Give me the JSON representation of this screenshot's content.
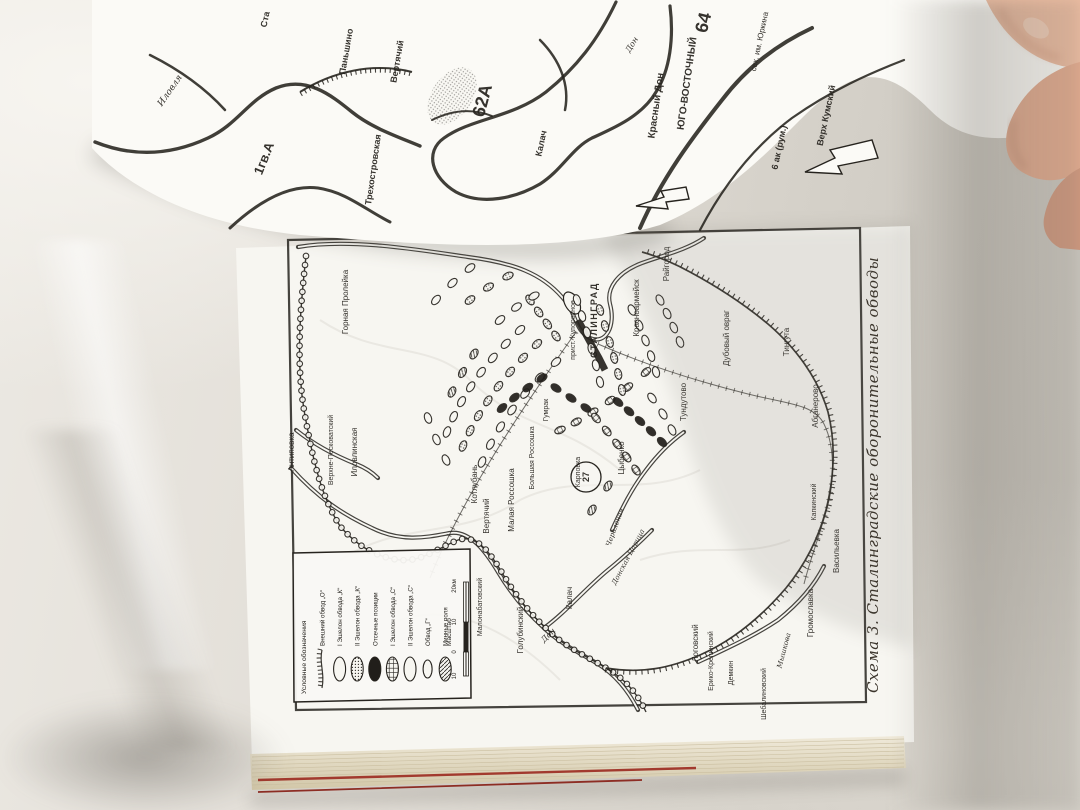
{
  "colors": {
    "page": "#f7f6f1",
    "page2": "#fbfaf6",
    "ink": "#26231e",
    "book-edge": "#e9e1cc",
    "red-ribbon": "#a23a2e",
    "skin1": "#ecbda2",
    "skin2": "#e3ac90",
    "skin3": "#d19a80"
  },
  "main_page_map": {
    "caption": "Схема 3. Сталинградские оборонительные обводы",
    "circled_number": "27",
    "labels": [
      {
        "text": "СТАЛИНГРАД",
        "x": 597,
        "y": 320,
        "s": 9,
        "b": true,
        "ls": 1.5
      },
      {
        "text": "прист. Купоросное",
        "x": 575,
        "y": 330,
        "s": 7
      },
      {
        "text": "Красноармейск",
        "x": 639,
        "y": 308,
        "s": 8
      },
      {
        "text": "Райгород",
        "x": 669,
        "y": 264,
        "s": 8
      },
      {
        "text": "Горная Пролейка",
        "x": 348,
        "y": 302,
        "s": 8
      },
      {
        "text": "Антиповка",
        "x": 294,
        "y": 452,
        "s": 8
      },
      {
        "text": "Верхне-Песковатский",
        "x": 333,
        "y": 450,
        "s": 7
      },
      {
        "text": "Иловлинская",
        "x": 357,
        "y": 452,
        "s": 8
      },
      {
        "text": "Котлубань",
        "x": 477,
        "y": 484,
        "s": 8
      },
      {
        "text": "Вертячий",
        "x": 489,
        "y": 516,
        "s": 8
      },
      {
        "text": "Малая Россошка",
        "x": 514,
        "y": 500,
        "s": 8
      },
      {
        "text": "Большая Россошка",
        "x": 534,
        "y": 458,
        "s": 7
      },
      {
        "text": "Гумрак",
        "x": 548,
        "y": 410,
        "s": 7
      },
      {
        "text": "Карповка",
        "x": 580,
        "y": 472,
        "s": 7
      },
      {
        "text": "Цыбенко",
        "x": 624,
        "y": 458,
        "s": 8
      },
      {
        "text": "Тундутово",
        "x": 686,
        "y": 402,
        "s": 8
      },
      {
        "text": "Дубовый овраг",
        "x": 729,
        "y": 338,
        "s": 8
      },
      {
        "text": "Тингута",
        "x": 789,
        "y": 342,
        "s": 8
      },
      {
        "text": "Абганерово",
        "x": 818,
        "y": 406,
        "s": 8
      },
      {
        "text": "Капкинский",
        "x": 816,
        "y": 502,
        "s": 7
      },
      {
        "text": "Васильевка",
        "x": 839,
        "y": 551,
        "s": 8
      },
      {
        "text": "Громославка",
        "x": 813,
        "y": 613,
        "s": 8
      },
      {
        "text": "Мышкова",
        "x": 786,
        "y": 651,
        "s": 7,
        "i": true,
        "r": -75
      },
      {
        "text": "Шебалиновский",
        "x": 766,
        "y": 694,
        "s": 7
      },
      {
        "text": "Демкин",
        "x": 733,
        "y": 673,
        "s": 7
      },
      {
        "text": "Ерико-Крепинский",
        "x": 713,
        "y": 661,
        "s": 7
      },
      {
        "text": "Логовский",
        "x": 698,
        "y": 643,
        "s": 8
      },
      {
        "text": "Донская Царица",
        "x": 630,
        "y": 558,
        "s": 7,
        "i": true,
        "r": -62
      },
      {
        "text": "Калач",
        "x": 572,
        "y": 598,
        "s": 8
      },
      {
        "text": "Дон",
        "x": 550,
        "y": 637,
        "s": 8,
        "i": true,
        "r": -45
      },
      {
        "text": "Голубинский",
        "x": 523,
        "y": 630,
        "s": 8
      },
      {
        "text": "Малонабатовский",
        "x": 482,
        "y": 607,
        "s": 7
      },
      {
        "text": "Червленая",
        "x": 617,
        "y": 528,
        "s": 7,
        "i": true,
        "r": -70
      }
    ],
    "legend": {
      "title": "Условные обозначения",
      "entries": [
        {
          "symbol": "hatched-line",
          "label": "Внешний обвод „О“"
        },
        {
          "symbol": "open-oval",
          "label": "I Эшелон обвода „К“"
        },
        {
          "symbol": "stippled-oval",
          "label": "II Эшелон обвода „К“"
        },
        {
          "symbol": "solid-oval",
          "label": "Отсечные позиции"
        },
        {
          "symbol": "grid-oval",
          "label": "I Эшелон обвода „С“"
        },
        {
          "symbol": "open-oval",
          "label": "II Эшелон обвода „С“"
        },
        {
          "symbol": "small-open-oval",
          "label": "Обвод „Г“"
        },
        {
          "symbol": "hatched-oval",
          "label": "Минные поля"
        }
      ],
      "scale": {
        "label": "Масштаб",
        "ticks": [
          "10",
          "0",
          "10",
          "20км"
        ]
      }
    }
  },
  "upper_page_map": {
    "labels": [
      {
        "text": "Ста",
        "x": 268,
        "y": 20,
        "r": -78,
        "s": 9,
        "b": true
      },
      {
        "text": "Иловля",
        "x": 172,
        "y": 92,
        "r": -55,
        "s": 9,
        "i": true
      },
      {
        "text": "Паньшино",
        "x": 349,
        "y": 52,
        "r": -80,
        "s": 9,
        "b": true
      },
      {
        "text": "Вертячий",
        "x": 400,
        "y": 62,
        "r": -80,
        "s": 9,
        "b": true
      },
      {
        "text": "Трехостровская",
        "x": 376,
        "y": 170,
        "r": -82,
        "s": 9,
        "b": true
      },
      {
        "text": "62А",
        "x": 488,
        "y": 102,
        "r": -75,
        "s": 18,
        "b": true
      },
      {
        "text": "1гв.А",
        "x": 268,
        "y": 160,
        "r": -68,
        "s": 13,
        "b": true
      },
      {
        "text": "Калач",
        "x": 544,
        "y": 144,
        "r": -78,
        "s": 9,
        "b": true
      },
      {
        "text": "Дон",
        "x": 634,
        "y": 46,
        "r": -58,
        "s": 8,
        "i": true
      },
      {
        "text": "Красный Дон",
        "x": 659,
        "y": 106,
        "r": -82,
        "s": 10,
        "b": true
      },
      {
        "text": "ЮГО-ВОСТОЧНЫЙ",
        "x": 690,
        "y": 84,
        "r": -82,
        "s": 10,
        "b": true
      },
      {
        "text": "64",
        "x": 709,
        "y": 24,
        "r": -76,
        "s": 18,
        "b": true
      },
      {
        "text": "свх. им. Юркина",
        "x": 762,
        "y": 42,
        "r": -78,
        "s": 8
      },
      {
        "text": "6 ак (рум.)",
        "x": 782,
        "y": 148,
        "r": -78,
        "s": 9,
        "b": true
      },
      {
        "text": "Верх Кумский",
        "x": 829,
        "y": 116,
        "r": -78,
        "s": 9,
        "b": true
      }
    ]
  }
}
